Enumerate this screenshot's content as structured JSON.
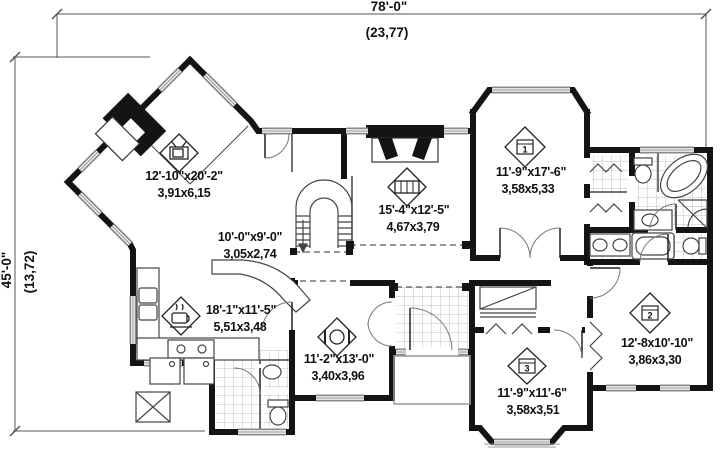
{
  "plan": {
    "width_imperial": "78'-0\"",
    "width_metric": "(23,77)",
    "depth_imperial": "45'-0\"",
    "depth_metric": "(13,72)"
  },
  "rooms": {
    "family": {
      "imperial": "12'-10\"x20'-2\"",
      "metric": "3,91x6,15"
    },
    "nook": {
      "imperial": "10'-0\"x9'-0\"",
      "metric": "3,05x2,74"
    },
    "kitchen": {
      "imperial": "18'-1\"x11'-5\"",
      "metric": "5,51x3,48"
    },
    "living": {
      "imperial": "15'-4\"x12'-5\"",
      "metric": "4,67x3,79"
    },
    "master": {
      "number": "1",
      "imperial": "11'-9\"x17'-6\"",
      "metric": "3,58x5,33"
    },
    "dining": {
      "imperial": "11'-2\"x13'-0\"",
      "metric": "3,40x3,96"
    },
    "bedroom2": {
      "number": "2",
      "imperial": "12'-8x10'-10\"",
      "metric": "3,86x3,30"
    },
    "bedroom3": {
      "number": "3",
      "imperial": "11'-9\"x11'-6\"",
      "metric": "3,58x3,51"
    }
  }
}
